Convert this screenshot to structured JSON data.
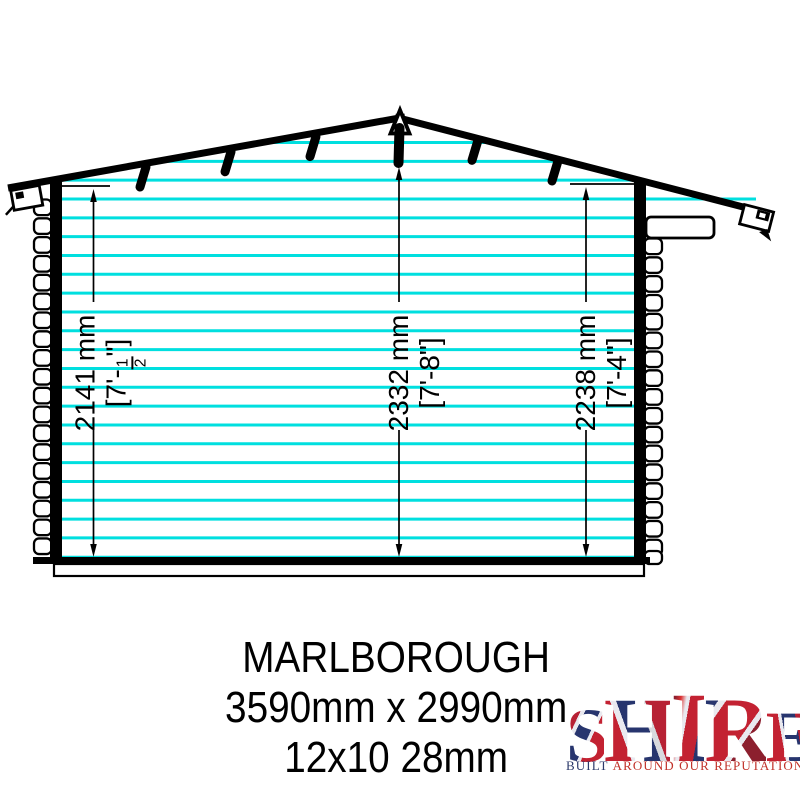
{
  "diagram": {
    "dimensions": {
      "left": {
        "metric": "2141 mm",
        "imperial_open": "[7'-",
        "fraction_numerator": "1",
        "fraction_denominator": "2",
        "imperial_close": "\"]"
      },
      "middle": {
        "metric": "2332 mm",
        "imperial": "[7'-8\"]"
      },
      "right": {
        "metric": "2238 mm",
        "imperial": "[7'-4\"]"
      }
    },
    "colors": {
      "cladding": "#00dfdf",
      "outline": "#000000"
    }
  },
  "title_block": {
    "model": "MARLBOROUGH",
    "size_metric": "3590mm x 2990mm",
    "size_nominal": "12x10 28mm"
  },
  "logo": {
    "brand": "SHIRE",
    "letters": [
      "S",
      "H",
      "I",
      "R",
      "E"
    ],
    "tagline_word1": "BUILT",
    "tagline_rest": "AROUND OUR REPUTATION",
    "colors": {
      "flag_red": "#c32232",
      "flag_blue": "#27356e",
      "tagline_red": "#c1322a",
      "tagline_blue": "#2c3a6b"
    }
  }
}
